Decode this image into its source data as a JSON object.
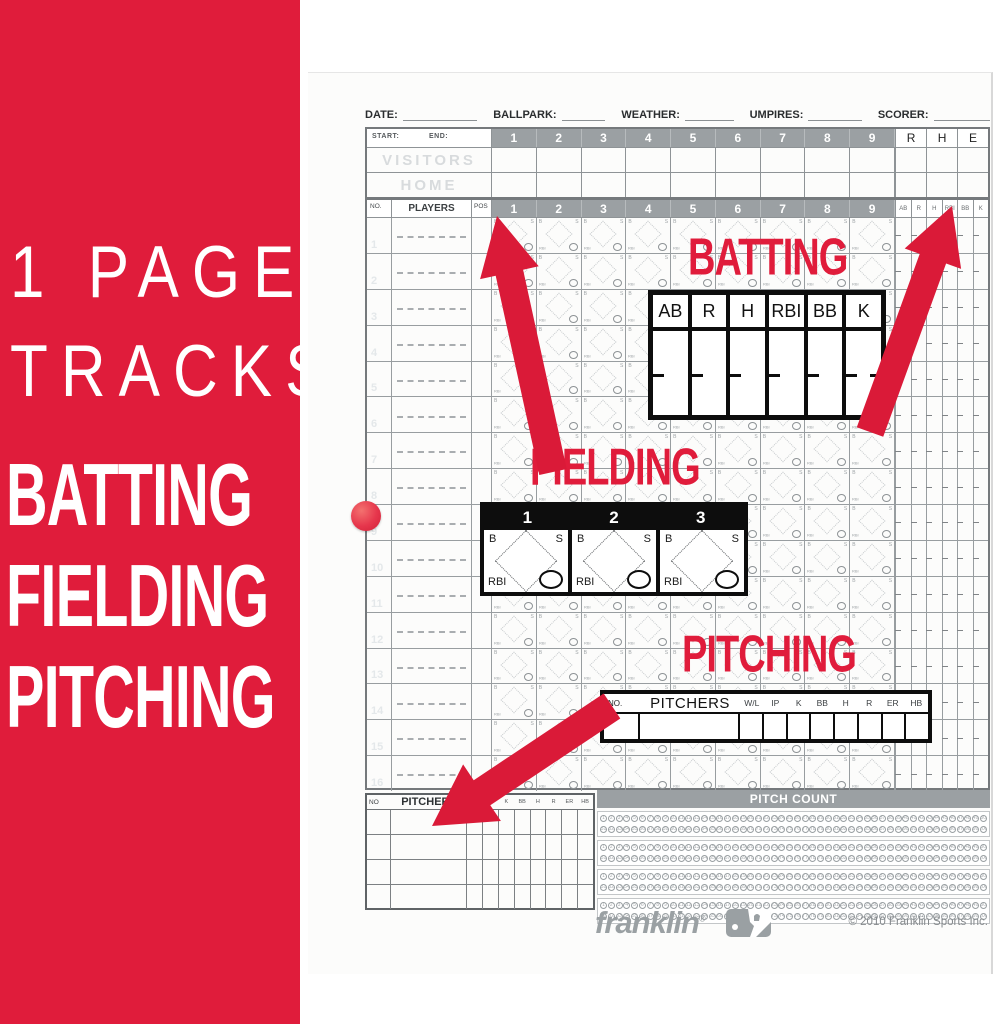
{
  "colors": {
    "brand_red": "#e01c3b",
    "header_band": "#9ba0a3",
    "ink": "#0d0d0d",
    "grid_line": "#8e9396",
    "paper": "#fcfcfb",
    "ghost_text": "#d8dbdd"
  },
  "banner": {
    "top_line1": "1 PAGE",
    "top_line2": "TRACKS",
    "features": [
      "BATTING",
      "FIELDING",
      "PITCHING"
    ]
  },
  "page": {
    "header_fields": [
      "DATE:",
      "BALLPARK:",
      "WEATHER:",
      "UMPIRES:",
      "SCORER:"
    ],
    "linescore": {
      "start_label": "START:",
      "end_label": "END:",
      "innings": [
        "1",
        "2",
        "3",
        "4",
        "5",
        "6",
        "7",
        "8",
        "9"
      ],
      "totals": [
        "R",
        "H",
        "E"
      ],
      "teams": [
        "VISITORS",
        "HOME"
      ]
    },
    "batting_grid": {
      "no": "NO.",
      "players": "PLAYERS",
      "pos": "POS",
      "innings": [
        "1",
        "2",
        "3",
        "4",
        "5",
        "6",
        "7",
        "8",
        "9"
      ],
      "stats": [
        "AB",
        "R",
        "H",
        "RBI",
        "BB",
        "K"
      ],
      "row_count": 16,
      "cell_marks": {
        "top_left": "B",
        "top_right": "S",
        "bottom_left": "RBI"
      }
    },
    "pitchers_table": {
      "no": "NO",
      "pitchers": "PITCHERS",
      "stats": [
        "W/L",
        "IP",
        "K",
        "BB",
        "H",
        "R",
        "ER",
        "HB"
      ],
      "row_count": 4
    },
    "pitch_count": {
      "title": "PITCH COUNT",
      "group_count": 4,
      "lines_per_group": 2,
      "bubbles_per_line": 50
    },
    "footer": {
      "brand": "franklin",
      "brand_mark": "®",
      "copyright": "© 2010 Franklin Sports Inc."
    }
  },
  "callouts": {
    "batting": {
      "title": "BATTING",
      "headers": [
        "AB",
        "R",
        "H",
        "RBI",
        "BB",
        "K"
      ]
    },
    "fielding": {
      "title": "FIELDING",
      "columns": [
        "1",
        "2",
        "3"
      ],
      "marks": {
        "top_left": "B",
        "top_right": "S",
        "bottom_left": "RBI"
      }
    },
    "pitching": {
      "title": "PITCHING",
      "no": "NO.",
      "pitchers": "PITCHERS",
      "stats": [
        "W/L",
        "IP",
        "K",
        "BB",
        "H",
        "R",
        "ER",
        "HB"
      ]
    }
  }
}
